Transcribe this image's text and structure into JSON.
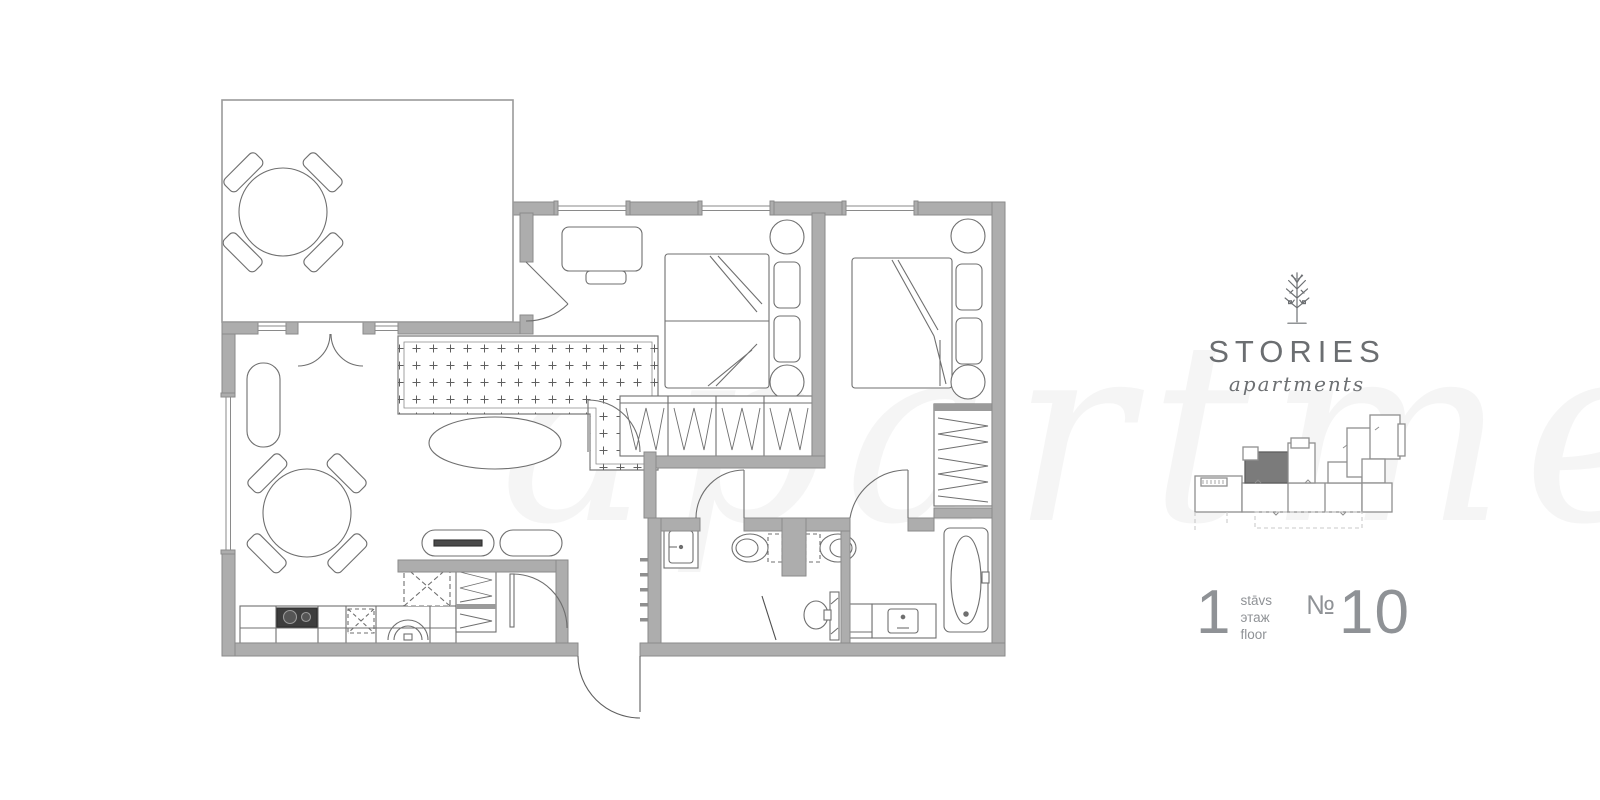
{
  "brand": {
    "name": "STORIES",
    "tagline": "apartments",
    "logo_icon": "tree-icon"
  },
  "floor_card": {
    "floor_number": "1",
    "floor_labels": [
      "stāvs",
      "этаж",
      "floor"
    ],
    "number_sign": "№",
    "apartment_number": "10"
  },
  "minimap": {
    "name": "building-footprint-map",
    "highlighted_unit": "apartment-10",
    "highlight_color": "#7b7b7b",
    "outline_color": "#8f8f8f"
  },
  "colors": {
    "background": "#ffffff",
    "wall_fill": "#adadad",
    "wall_stroke": "#8a8a8a",
    "furniture_line": "#6f6f6f",
    "text_gray": "#8f9296",
    "logo_gray": "#6b6e71"
  },
  "plan_elements": [
    "terrace",
    "terrace-dining-table",
    "terrace-chairs",
    "living-room-rug",
    "coffee-table",
    "plant",
    "dining-table",
    "dining-chairs",
    "kitchen-counter",
    "cooktop",
    "kitchen-sink",
    "tall-cabinet",
    "hall-wardrobe",
    "bench",
    "bench-radiator",
    "bedroom-1",
    "desk",
    "desk-chair",
    "double-bed-1",
    "nightstand",
    "side-table",
    "wardrobe-1",
    "bedroom-2",
    "double-bed-2",
    "wardrobe-2",
    "hallway",
    "bathroom",
    "washbasin",
    "towel-radiator",
    "toilet",
    "toilet-pair",
    "bathtub",
    "vanity-sink",
    "washing-machine",
    "entrance-door",
    "interior-doors",
    "windows",
    "french-doors"
  ]
}
